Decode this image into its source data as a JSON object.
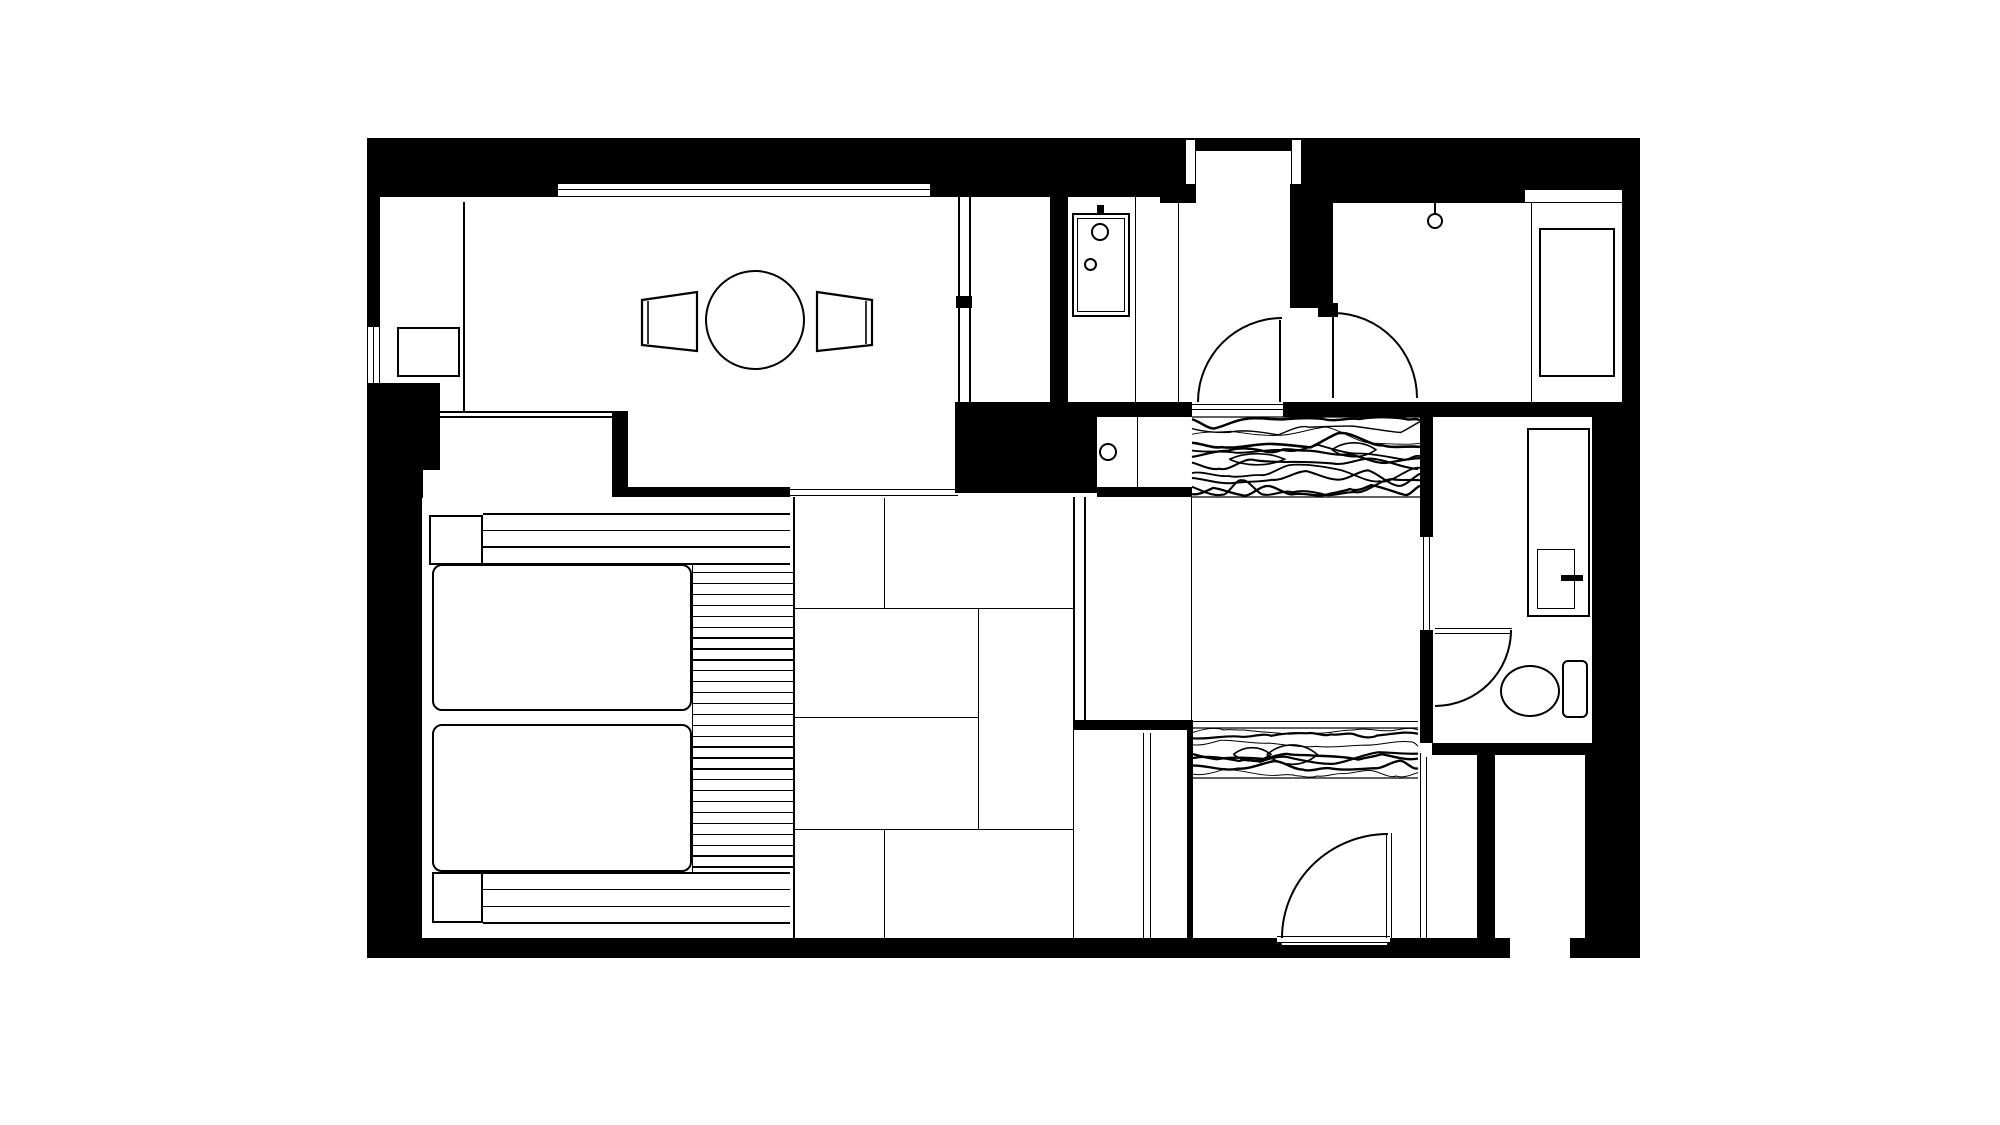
{
  "meta": {
    "type": "architectural-floor-plan",
    "description": "black and white hotel-room floor plan, no text labels rendered",
    "ink_color": "#000000",
    "paper_color": "#ffffff"
  },
  "canvas": {
    "width": 2000,
    "height": 1125
  },
  "floorplan": {
    "walls": [
      {
        "n": "top-wall-left",
        "x": 367,
        "y": 138,
        "w": 191,
        "h": 59
      },
      {
        "n": "top-wall-above-window",
        "x": 558,
        "y": 138,
        "w": 372,
        "h": 45
      },
      {
        "n": "top-wall-left2",
        "x": 930,
        "y": 138,
        "w": 28,
        "h": 59
      },
      {
        "n": "top-wall-mid",
        "x": 958,
        "y": 138,
        "w": 222,
        "h": 59
      },
      {
        "n": "entrance-lintel",
        "x": 1180,
        "y": 138,
        "w": 122,
        "h": 46
      },
      {
        "n": "wall-under-jamb",
        "x": 1160,
        "y": 182,
        "w": 36,
        "h": 21
      },
      {
        "n": "vestibule-column",
        "x": 1290,
        "y": 182,
        "w": 43,
        "h": 126
      },
      {
        "n": "door-hinge-stub",
        "x": 1318,
        "y": 303,
        "w": 20,
        "h": 14
      },
      {
        "n": "top-wall-right",
        "x": 1302,
        "y": 138,
        "w": 223,
        "h": 65
      },
      {
        "n": "top-wall-right2",
        "x": 1525,
        "y": 138,
        "w": 115,
        "h": 52
      },
      {
        "n": "right-wall-upper",
        "x": 1622,
        "y": 190,
        "w": 18,
        "h": 215
      },
      {
        "n": "right-wall-mid",
        "x": 1592,
        "y": 405,
        "w": 48,
        "h": 348
      },
      {
        "n": "right-wall-lower",
        "x": 1585,
        "y": 753,
        "w": 55,
        "h": 190
      },
      {
        "n": "bottom-wall",
        "x": 367,
        "y": 938,
        "w": 1273,
        "h": 20
      },
      {
        "n": "left-wall-upper",
        "x": 367,
        "y": 138,
        "w": 13,
        "h": 189
      },
      {
        "n": "left-wall-block",
        "x": 367,
        "y": 383,
        "w": 73,
        "h": 115
      },
      {
        "n": "left-wall-lower",
        "x": 367,
        "y": 498,
        "w": 55,
        "h": 440
      },
      {
        "n": "living-south-stub",
        "x": 612,
        "y": 411,
        "w": 16,
        "h": 86
      },
      {
        "n": "bedroom-north-wall",
        "x": 628,
        "y": 487,
        "w": 162,
        "h": 10
      },
      {
        "n": "service-black-block",
        "x": 955,
        "y": 402,
        "w": 142,
        "h": 91
      },
      {
        "n": "bar-above-sink",
        "x": 1097,
        "y": 402,
        "w": 95,
        "h": 15
      },
      {
        "n": "bar-below-sink",
        "x": 1097,
        "y": 487,
        "w": 95,
        "h": 10
      },
      {
        "n": "living-closet-wall",
        "x": 1050,
        "y": 197,
        "w": 18,
        "h": 205
      },
      {
        "n": "closet-line-notch",
        "x": 956,
        "y": 296,
        "w": 16,
        "h": 12
      },
      {
        "n": "wall-y402-right",
        "x": 1283,
        "y": 402,
        "w": 357,
        "h": 15
      },
      {
        "n": "toilet-left-wall",
        "x": 1420,
        "y": 417,
        "w": 13,
        "h": 326
      },
      {
        "n": "toilet-bottom-wall",
        "x": 1432,
        "y": 743,
        "w": 161,
        "h": 12
      },
      {
        "n": "shaft-divider",
        "x": 1477,
        "y": 753,
        "w": 18,
        "h": 190
      },
      {
        "n": "oshiire-top-wall",
        "x": 1073,
        "y": 720,
        "w": 120,
        "h": 10
      },
      {
        "n": "oshiire-right-wall",
        "x": 1187,
        "y": 730,
        "w": 6,
        "h": 208
      }
    ],
    "insets": [
      {
        "n": "window-top",
        "x": 558,
        "y": 183,
        "w": 372,
        "h": 14,
        "bt": 1.4,
        "bb": 1.4
      },
      {
        "n": "window-left",
        "x": 367,
        "y": 327,
        "w": 13,
        "h": 56,
        "bl": 1.4,
        "br": 1.4
      },
      {
        "n": "bedroom-wall-notch",
        "x": 423,
        "y": 470,
        "w": 17,
        "h": 85
      },
      {
        "n": "entrance-jamb-left",
        "x": 1185,
        "y": 140,
        "w": 11,
        "h": 44,
        "bl": 1.2,
        "br": 1.2
      },
      {
        "n": "entrance-jamb-right",
        "x": 1291,
        "y": 140,
        "w": 11,
        "h": 44,
        "bl": 1.2,
        "br": 1.2
      },
      {
        "n": "entrance-doorway",
        "x": 1196,
        "y": 150,
        "w": 95,
        "h": 34,
        "bt": 1.5
      },
      {
        "n": "sink-niche-a",
        "x": 1097,
        "y": 417,
        "w": 40,
        "h": 70
      },
      {
        "n": "sink-niche-b",
        "x": 1137,
        "y": 417,
        "w": 55,
        "h": 70,
        "bl": 1.2
      },
      {
        "n": "toilet-pocket-door",
        "x": 1420,
        "y": 537,
        "w": 13,
        "h": 93
      },
      {
        "n": "entry-door-sill",
        "x": 1277,
        "y": 933,
        "w": 113,
        "h": 12
      },
      {
        "n": "bottom-wall-gap",
        "x": 1510,
        "y": 938,
        "w": 60,
        "h": 20
      },
      {
        "n": "cabinet-top-strip",
        "x": 1525,
        "y": 190,
        "w": 97,
        "h": 13,
        "bb": 1.2
      }
    ],
    "lines": [
      {
        "n": "living-alcove-partition",
        "o": "v",
        "x": 463,
        "y": 202,
        "len": 210,
        "t": 1.6
      },
      {
        "n": "living-closet-line-a",
        "o": "v",
        "x": 958,
        "y": 197,
        "len": 205,
        "t": 1.6
      },
      {
        "n": "living-closet-line-b",
        "o": "v",
        "x": 969,
        "y": 197,
        "len": 205,
        "t": 1.6
      },
      {
        "n": "shower-glass-line",
        "o": "v",
        "x": 1135,
        "y": 197,
        "len": 205,
        "t": 1.4
      },
      {
        "n": "washroom-partition",
        "o": "v",
        "x": 1178,
        "y": 203,
        "len": 199,
        "t": 1.4
      },
      {
        "n": "hall-west-line",
        "o": "v",
        "x": 1191,
        "y": 497,
        "len": 225,
        "t": 1.4
      },
      {
        "n": "tatami-partition-a",
        "o": "v",
        "x": 1073,
        "y": 497,
        "len": 233,
        "t": 1.6
      },
      {
        "n": "tatami-partition-b",
        "o": "v",
        "x": 1084,
        "y": 497,
        "len": 233,
        "t": 1.6
      },
      {
        "n": "tatami-line-1",
        "o": "v",
        "x": 884,
        "y": 498,
        "len": 110,
        "t": 1.4
      },
      {
        "n": "tatami-line-2",
        "o": "h",
        "x": 793,
        "y": 608,
        "len": 280,
        "t": 1.4
      },
      {
        "n": "tatami-line-3",
        "o": "v",
        "x": 978,
        "y": 608,
        "len": 221,
        "t": 1.4
      },
      {
        "n": "tatami-line-4",
        "o": "h",
        "x": 793,
        "y": 717,
        "len": 185,
        "t": 1.4
      },
      {
        "n": "tatami-line-5",
        "o": "h",
        "x": 793,
        "y": 829,
        "len": 280,
        "t": 1.4
      },
      {
        "n": "tatami-line-6",
        "o": "v",
        "x": 884,
        "y": 829,
        "len": 109,
        "t": 1.4
      },
      {
        "n": "bedroom-tatami-edge",
        "o": "v",
        "x": 793,
        "y": 497,
        "len": 441,
        "t": 1.6
      },
      {
        "n": "slat-column-edge",
        "o": "v",
        "x": 692,
        "y": 564,
        "len": 308,
        "t": 1.4
      },
      {
        "n": "oshiire-left-line",
        "o": "v",
        "x": 1073,
        "y": 730,
        "len": 208,
        "t": 1.4
      },
      {
        "n": "oshiire-door-a",
        "o": "v",
        "x": 1143,
        "y": 733,
        "len": 205,
        "t": 1.4
      },
      {
        "n": "oshiire-door-b",
        "o": "v",
        "x": 1150,
        "y": 733,
        "len": 205,
        "t": 1.4
      },
      {
        "n": "vestibule-shaft-line",
        "o": "v",
        "x": 1420,
        "y": 753,
        "len": 185,
        "t": 1.4
      },
      {
        "n": "shaft-inner-line",
        "o": "v",
        "x": 1426,
        "y": 757,
        "len": 181,
        "t": 1.2
      },
      {
        "n": "room-door-leaf",
        "o": "v",
        "x": 1332,
        "y": 312,
        "len": 86,
        "t": 2.2
      },
      {
        "n": "washroom-door-leaf",
        "o": "v",
        "x": 1279,
        "y": 320,
        "len": 82,
        "t": 2.2
      },
      {
        "n": "cabinet-divider",
        "o": "v",
        "x": 1531,
        "y": 203,
        "len": 200,
        "t": 1.4
      },
      {
        "n": "genkan-track-a",
        "o": "h",
        "x": 1192,
        "y": 404,
        "len": 91,
        "t": 1.4
      },
      {
        "n": "genkan-track-b",
        "o": "h",
        "x": 1192,
        "y": 409,
        "len": 91,
        "t": 1.4
      },
      {
        "n": "tatami-track-a",
        "o": "h",
        "x": 790,
        "y": 489,
        "len": 168,
        "t": 1.4
      },
      {
        "n": "tatami-track-b",
        "o": "h",
        "x": 790,
        "y": 495,
        "len": 168,
        "t": 1.4
      },
      {
        "n": "living-bed-divider-a",
        "o": "h",
        "x": 440,
        "y": 411,
        "len": 172,
        "t": 1.6
      },
      {
        "n": "living-bed-divider-b",
        "o": "h",
        "x": 440,
        "y": 416,
        "len": 172,
        "t": 1.6
      },
      {
        "n": "toilet-door-leaf-a",
        "o": "h",
        "x": 1435,
        "y": 628,
        "len": 77,
        "t": 1.4
      },
      {
        "n": "toilet-door-leaf-b",
        "o": "h",
        "x": 1435,
        "y": 633,
        "len": 77,
        "t": 1.4
      },
      {
        "n": "window-top-midline",
        "o": "h",
        "x": 558,
        "y": 189,
        "len": 372,
        "t": 1.1
      },
      {
        "n": "window-left-midline",
        "o": "v",
        "x": 373,
        "y": 327,
        "len": 56,
        "t": 1.1
      },
      {
        "n": "pocket-door-line-a",
        "o": "v",
        "x": 1423,
        "y": 537,
        "len": 93,
        "t": 1.1
      },
      {
        "n": "pocket-door-line-b",
        "o": "v",
        "x": 1429,
        "y": 537,
        "len": 93,
        "t": 1.1
      },
      {
        "n": "sill-line-a",
        "o": "h",
        "x": 1277,
        "y": 936,
        "len": 113,
        "t": 1.4
      },
      {
        "n": "sill-line-b",
        "o": "h",
        "x": 1277,
        "y": 942,
        "len": 113,
        "t": 1.4
      },
      {
        "n": "entry-leaf-a",
        "o": "v",
        "x": 1386,
        "y": 833,
        "len": 105,
        "t": 1.4
      },
      {
        "n": "entry-leaf-b",
        "o": "v",
        "x": 1391,
        "y": 833,
        "len": 105,
        "t": 1.4
      },
      {
        "n": "light-stem",
        "o": "v",
        "x": 1434,
        "y": 203,
        "len": 11,
        "t": 2
      },
      {
        "n": "hall-wood-edge",
        "o": "h",
        "x": 1193,
        "y": 721,
        "len": 225,
        "t": 1.2
      }
    ],
    "slat_groups": [
      {
        "n": "bed-platform-slats-top",
        "x": 483,
        "w": 307,
        "y0": 513,
        "gap": 16.7,
        "count": 4,
        "t": 1.6
      },
      {
        "n": "bed-platform-slats-right",
        "x": 692,
        "w": 101,
        "y0": 572,
        "gap": 10.9,
        "count": 28,
        "t": 1.4
      },
      {
        "n": "bed-platform-slats-bottom",
        "x": 483,
        "w": 307,
        "y0": 872,
        "gap": 16.8,
        "count": 4,
        "t": 1.6
      }
    ],
    "rects": [
      {
        "n": "tv-board",
        "x": 397,
        "y": 327,
        "w": 63,
        "h": 50,
        "t": 2
      },
      {
        "n": "shower-unit-outer",
        "x": 1072,
        "y": 213,
        "w": 58,
        "h": 104,
        "t": 2
      },
      {
        "n": "shower-unit-inner",
        "x": 1077,
        "y": 218,
        "w": 48,
        "h": 94,
        "t": 1
      },
      {
        "n": "closet-cabinet",
        "x": 1539,
        "y": 228,
        "w": 76,
        "h": 149,
        "t": 2
      },
      {
        "n": "vanity-counter",
        "x": 1527,
        "y": 428,
        "w": 63,
        "h": 189,
        "t": 2
      },
      {
        "n": "vanity-sink",
        "x": 1537,
        "y": 549,
        "w": 38,
        "h": 60,
        "t": 1.6
      },
      {
        "n": "mattress-1",
        "x": 432,
        "y": 564,
        "w": 260,
        "h": 147,
        "t": 2.4,
        "r": 10
      },
      {
        "n": "mattress-2",
        "x": 432,
        "y": 724,
        "w": 260,
        "h": 148,
        "t": 2.4,
        "r": 10
      },
      {
        "n": "nightstand-1",
        "x": 429,
        "y": 515,
        "w": 54,
        "h": 50,
        "t": 2
      },
      {
        "n": "nightstand-2",
        "x": 432,
        "y": 872,
        "w": 51,
        "h": 51,
        "t": 2
      },
      {
        "n": "toilet-tank",
        "x": 1562,
        "y": 660,
        "w": 26,
        "h": 58,
        "t": 2,
        "r": 6
      }
    ],
    "filled_rects": [
      {
        "n": "shower-head-mount",
        "x": 1097,
        "y": 205,
        "w": 7,
        "h": 9
      },
      {
        "n": "vanity-faucet",
        "x": 1561,
        "y": 575,
        "w": 22,
        "h": 6
      }
    ],
    "circles": [
      {
        "n": "dining-table",
        "cx": 755,
        "cy": 320,
        "r": 50,
        "t": 2.8
      },
      {
        "n": "shower-head",
        "cx": 1100,
        "cy": 232,
        "r": 9,
        "t": 2
      },
      {
        "n": "shower-control",
        "cx": 1090,
        "cy": 264,
        "r": 6.5,
        "t": 2
      },
      {
        "n": "hall-sink-drain",
        "cx": 1108,
        "cy": 452,
        "r": 9,
        "t": 2
      },
      {
        "n": "ceiling-light",
        "cx": 1435,
        "cy": 221,
        "r": 8,
        "t": 2
      },
      {
        "n": "hinge-dot-left",
        "cx": 1279,
        "cy": 944,
        "r": 2.5,
        "t": 0,
        "fill": true
      },
      {
        "n": "hinge-dot-right",
        "cx": 1389,
        "cy": 944,
        "r": 2.5,
        "t": 0,
        "fill": true
      }
    ],
    "ellipses": [
      {
        "n": "toilet-bowl",
        "x": 1500,
        "y": 665,
        "w": 60,
        "h": 52,
        "t": 2.4
      }
    ],
    "arcs": [
      {
        "n": "washroom-door-swing",
        "x": 1197,
        "y": 317,
        "w": 85,
        "h": 85,
        "c": "tl",
        "t": 2
      },
      {
        "n": "room-door-swing",
        "x": 1333,
        "y": 312,
        "w": 85,
        "h": 86,
        "c": "tr",
        "t": 2
      },
      {
        "n": "toilet-door-swing",
        "x": 1435,
        "y": 630,
        "w": 77,
        "h": 77,
        "c": "br",
        "t": 2
      },
      {
        "n": "entry-door-swing",
        "x": 1281,
        "y": 833,
        "w": 107,
        "h": 105,
        "c": "tl",
        "t": 2
      }
    ],
    "polygons": [
      {
        "n": "chair-left",
        "pts": "642,300 697,292 697,351 642,345",
        "t": 2.2,
        "inner": "648,301 648,344"
      },
      {
        "n": "chair-right",
        "pts": "817,292 872,300 872,345 817,351",
        "t": 2.2,
        "inner": "866,301 866,344"
      }
    ],
    "wood_strips": [
      {
        "n": "genkan-wood-upper",
        "x": 1192,
        "y": 417,
        "w": 228,
        "h": 80,
        "lines": 11,
        "seed": 7
      },
      {
        "n": "genkan-wood-lower",
        "x": 1193,
        "y": 728,
        "w": 225,
        "h": 50,
        "lines": 7,
        "seed": 13
      }
    ]
  }
}
